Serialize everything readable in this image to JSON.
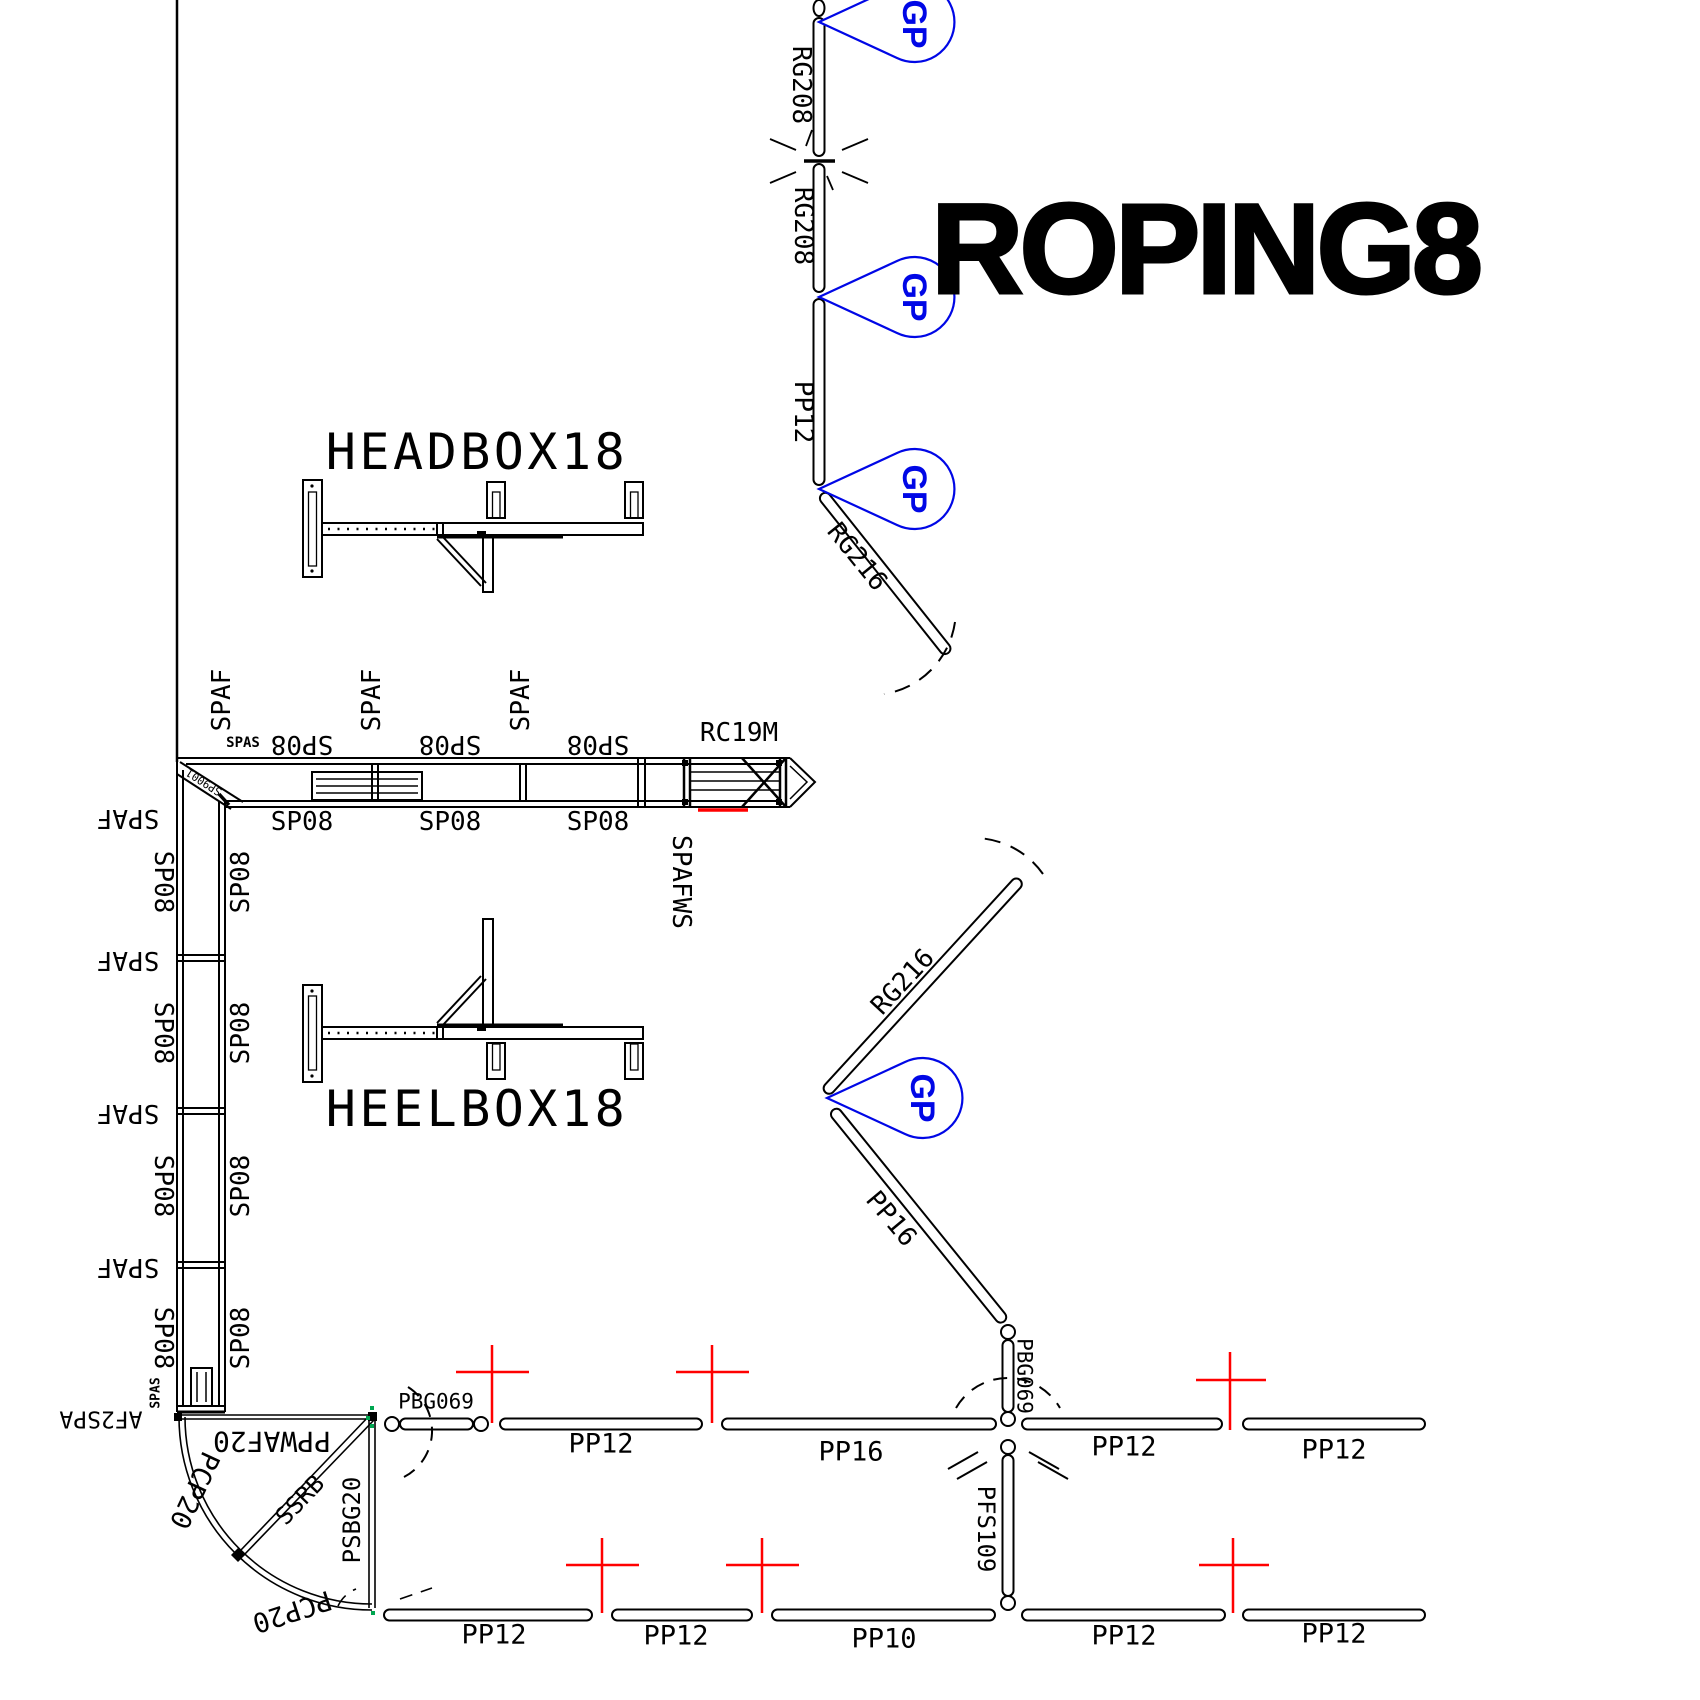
{
  "title": "ROPING8",
  "gp_marker": "GP",
  "colors": {
    "line": "#000000",
    "marker_blue": "#0007e6",
    "cross_red": "#ff0000",
    "connector_green": "#00a650"
  },
  "boxes": {
    "headbox": "HEADBOX18",
    "heelbox": "HEELBOX18"
  },
  "chute": {
    "name": "RC19M",
    "wing_label": "SPAFWS"
  },
  "chain": {
    "panels": [
      "RG208",
      "RG208",
      "PP12"
    ]
  },
  "diagonals": {
    "upper_gate": "RG216",
    "lower_gate": "RG216",
    "pp16": "PP16"
  },
  "alley_horizontal": {
    "top": [
      "SP08",
      "SP08",
      "SP08"
    ],
    "bottom": [
      "SP08",
      "SP08",
      "SP08"
    ],
    "posts": [
      "SPAF",
      "SPAF",
      "SPAF"
    ],
    "small_tag": "SPAS",
    "corner_tag": "SP9001"
  },
  "alley_vertical": {
    "left_posts": [
      "SPAF",
      "SPAF",
      "SPAF",
      "SPAF"
    ],
    "left": [
      "SP08",
      "SP08",
      "SP08",
      "SP08"
    ],
    "right": [
      "SP08",
      "SP08",
      "SP08",
      "SP08"
    ],
    "end_tag": "AF2SPA",
    "small_tag": "SPAS"
  },
  "corner_gate": {
    "gate": "PPWAF20",
    "arc1": "PCP20",
    "arc2": "PCP20",
    "brace": "SSRB",
    "post": "PSBG20"
  },
  "center_column": {
    "upper": "PBG069",
    "lower": "PFS109"
  },
  "row_upper": [
    "PBG069",
    "PP12",
    "PP16",
    "PP12",
    "PP12"
  ],
  "row_lower": [
    "PP12",
    "PP12",
    "PP10",
    "PP12",
    "PP12"
  ]
}
